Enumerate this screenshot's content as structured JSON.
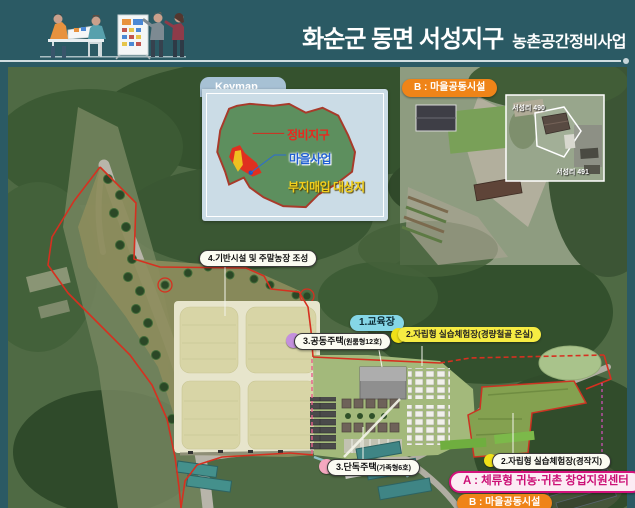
{
  "header": {
    "title_main": "화순군 동면 서성지구",
    "title_sub": "농촌공간정비사업"
  },
  "keymap": {
    "tab": "Keymap",
    "legend_jeongbi": "정비지구",
    "legend_maeul": "마을사업",
    "legend_buji": "부지매입 대상지"
  },
  "photo_inset": {
    "label": "B : 마을공동시설",
    "parcel_1": "서성리 490",
    "parcel_2": "서성리 491"
  },
  "annotations": {
    "infra": "4.기반시설 및 주말농장 조성",
    "edu": "1.교육장",
    "practice_greenhouse": "2.자립형 실습체험장(경량철골 온실)",
    "apt_main": "3.공동주택",
    "apt_sub": "(원룸형12호)",
    "house_main": "3.단독주택",
    "house_sub": "(가족형6호)",
    "practice_farm": "2.자립형 실습체험장(경작지)",
    "center_a": "A : 체류형 귀농·귀촌 창업지원센터",
    "village_b": "B : 마을공동시설"
  },
  "colors": {
    "header_bg": "#2B5A64",
    "orange": "#EF8418",
    "magenta": "#D4127C",
    "yellow": "#F6EC43",
    "cyan": "#85D6E6",
    "purple": "#C490DD",
    "pink": "#F5A8C0",
    "boundary_red": "#D63020"
  }
}
